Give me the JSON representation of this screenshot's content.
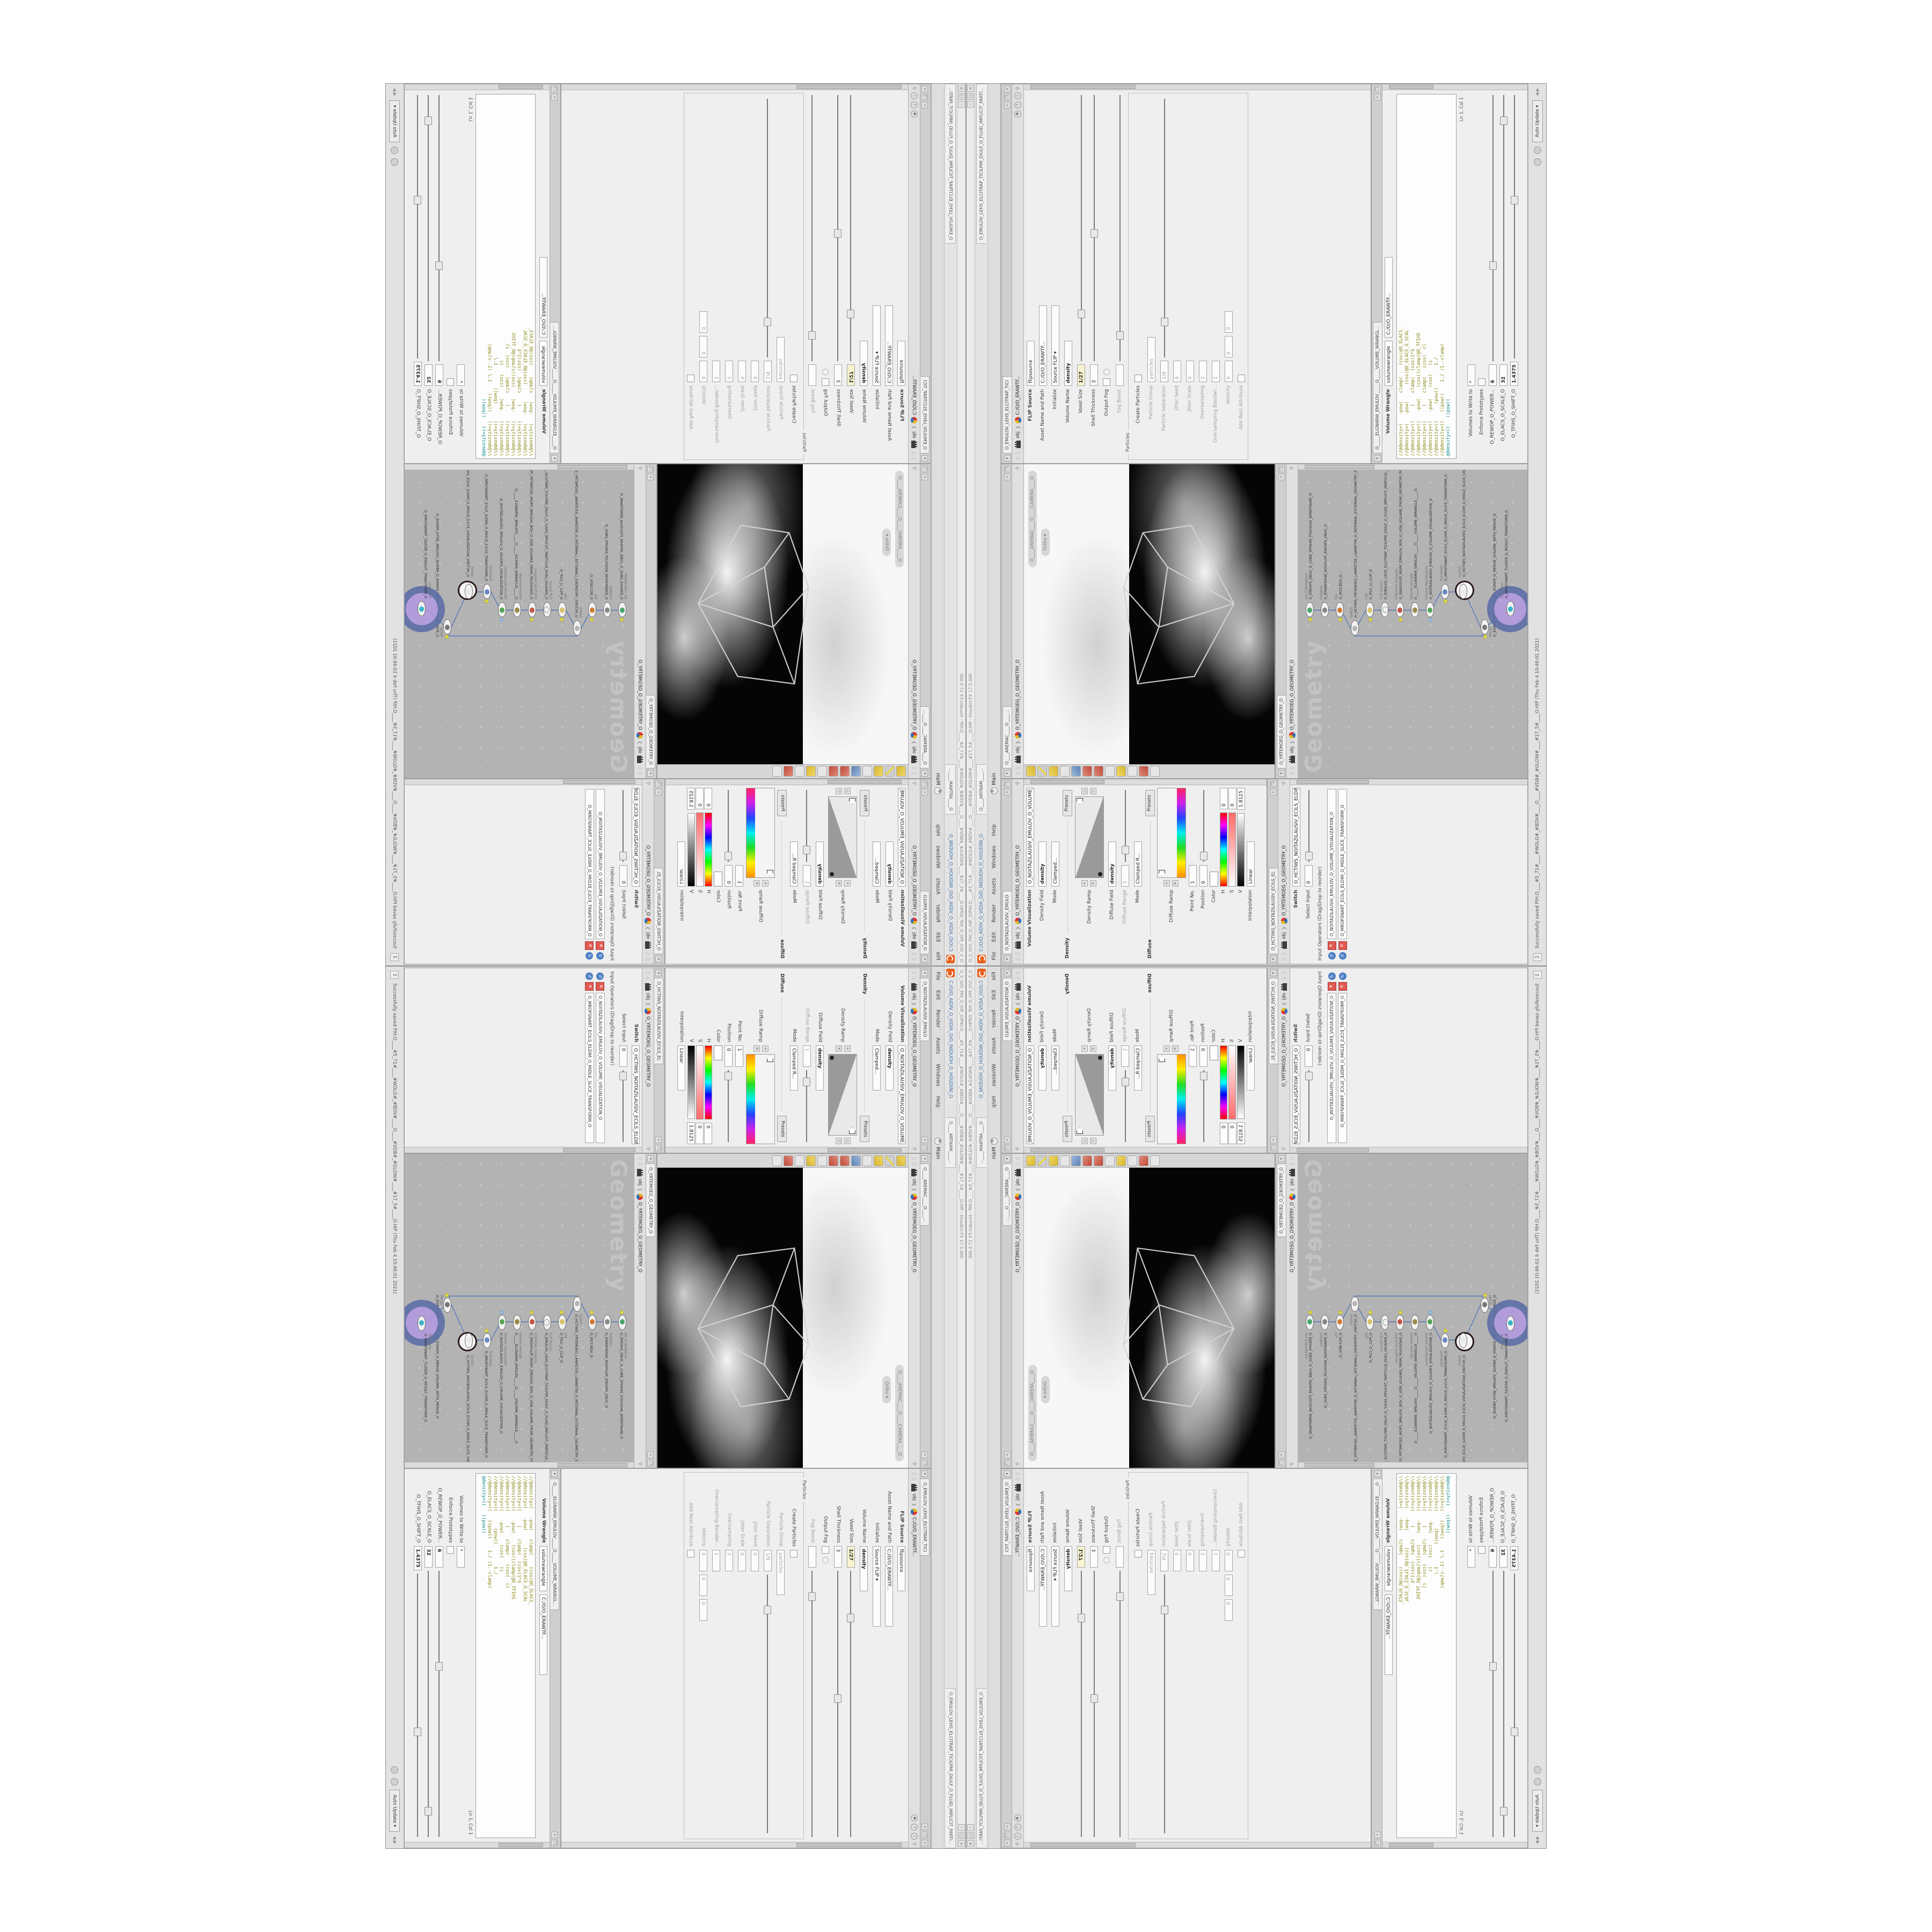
{
  "window": {
    "title": "O_5_O/O_PIH_O_HIP_O/PIH.O____#5_71#____#WOLG#_#BDV#____O____#VDB#_#GLOW#____#17_5#____O.HIP - Houdini FX 17.5.460",
    "install_path": "C:/O/O_AIDIV_O_VIDIA_O/O_INIDUOH_O_HOUDINI_O",
    "flip_window_tab": "O_EMULOV_LEHS_ELCITRAP_TICILPMI_DIULF_O_FLUID_IMPLICIT_PARTI...",
    "mantra_tab": "O____ARTNAM____...",
    "menus": [
      "File",
      "Edit",
      "Render",
      "Assets",
      "Windows",
      "Help"
    ],
    "desktop": "Main",
    "status_badge": "2",
    "status_message": "Successfully saved PIH.O____#5_71#____#WOLG#_#BDV#____O____#VDB#_#GLOW#____#17_5#____O.HIP (Thu Feb  4 10:46:01 2021)",
    "update_mode": "Auto Update",
    "accent_orange": "#e8601c",
    "selection_purple": "#b29ade"
  },
  "viewport": {
    "tab": "O____AREMAC____O____...",
    "crumb": "obj",
    "path": "O_YRTEMOEG_O_GEOMETRY_O",
    "camera_pill": "O____AREMAC____O____CAMERA____O",
    "ortho_pill": "Ortho"
  },
  "network": {
    "tab": "O_YRTEMOEG_O_GEOMETRY_O",
    "crumb": "obj",
    "path": "O_YRTEMOEG_O_GEOMETRY_O",
    "watermark": "Geometry",
    "nodes": [
      {
        "type": "am_CubeSphere",
        "name": "O_EREHPS_EBUC_O_CUBE_SPHERE_POLYGON_WIREFRAME_O"
      },
      {
        "type": "PolyWire",
        "name": "O_EMARFERIW_NOGYLOP_EREHPS_EBUC_O"
      },
      {
        "type": "File",
        "name": "O_M23.BDV_O..."
      },
      {
        "type": "Switch",
        "name": "O_HCTIWS_YRTEMOEG_LANRETXE_LANRETNI_O_INTERNAL_EXTERNAL_GEOMETRY_SWITCH_O"
      },
      {
        "type": "Clip",
        "name": "O_PILC_O_CLIP_O"
      },
      {
        "type": "FLIP Source",
        "name": "O_EMULOV_LEHS_ELCITRAP_TICILPMI_DIULF_O_FLUID_IMPLICIT_PARTICLE_SHEL_VOLUME_O"
      },
      {
        "type": "VDB from Polygons",
        "name": "O_SNOGYLOP_MORF_EMULOV_BDV_O_VDB_VOLUME_FROM_GEOMETRY_POLYGONS_O"
      },
      {
        "type": "Volume Wrangle",
        "name": "O_____ELGNARW_EMULOV_____O_____VOLUME_WRANGLE_____O"
      },
      {
        "type": "Volume Visualization",
        "name": "O_NOITAZILAUSIV_EMULOV_O_VOLUME_VISUALIZATION_O"
      },
      {
        "type": "Transform",
        "name": "O_MROFSNART_ECILS_ELDIM_O_MIDLE_SLICE_TRANSFORM_O"
      },
      {
        "type": "Switch",
        "name": "O_HCTIWS_NOITAZILAUSIV_ECILS_ELDIM_O_MIDLE_SLICE_VISUALIZATION_SWITCH_O"
      },
      {
        "type": "Merge",
        "name": "O_EGREM_HTIW_EMULOV_EGREM_O_MERGE_VOLUME_WITH_MERGE_O"
      },
      {
        "type": "Transform",
        "name": "O_MROFSNART_TLUSER_O_RESULT_TRANSFORM_O"
      }
    ]
  },
  "volume_visualization": {
    "tab": "O_NOITAZILAUSIV_EMULO",
    "crumb": "obj",
    "path": "O_YRTEMOEG_O_GEOMETRY_O",
    "title": "Volume Visualization",
    "density_field_label": "Density Field",
    "density_field": "density",
    "mode_label": "Mode",
    "density_mode": "Clamped...",
    "density_section": "Density",
    "presets": "Presets",
    "density_ramp_label": "Density Ramp",
    "diffuse_field_label": "Diffuse Field",
    "diffuse_field": "density",
    "diffuse_range_label": "Diffuse Range",
    "diffuse_range": "1",
    "diffuse_mode": "Clamped R...",
    "diffuse_section": "Diffuse",
    "diffuse_ramp_label": "Diffuse Ramp",
    "point_no_label": "Point No.",
    "point_no": "1",
    "position_label": "Position",
    "position": "0",
    "color_label": "Color",
    "h_label": "H",
    "h_value": "0",
    "s_label": "S",
    "s_value": "0",
    "v_label": "V",
    "v_value": "1.8125",
    "interpolation_label": "Interpolation",
    "interpolation": "Linear"
  },
  "switch_pane": {
    "tab": "O_HCTIWS_NOITAZILAUSIV_ECILS_EL",
    "crumb": "obj",
    "path": "O_YRTEMOEG_O_GEOMETRY_O",
    "title": "Switch",
    "select_input_label": "Select Input",
    "select_input": "0",
    "operators_label": "Input Operators (Drag/Drop to reorder)",
    "inputs": [
      "O_NOITAZILAUSIV_EMULOV_O_VOLUME_VISUALIZATION_O",
      "O_MROFSNART_ECILS_ELDIM_O_MIDLE_SLICE_TRANSFORM_O"
    ]
  },
  "flip_source": {
    "tab": "O_EMULOV_LEHS_ELCITRAP_TICI",
    "asset_path": "C:/O/O_ERAWTF...",
    "title": "FLIP Source",
    "node_name": "flipsource",
    "asset_label": "Asset Name and Path",
    "initialize_label": "Initialize",
    "initialize": "Source FLIP",
    "volume_name_label": "Volume Name",
    "volume_name": "density",
    "voxel_size_label": "Voxel Size",
    "voxel_size": "1/27",
    "shell_thickness_label": "Shell Thickness",
    "shell_thickness": "3",
    "output_fog_label": "Output Fog",
    "fog_boost_label": "Fog Boost",
    "particles_group": "Particles",
    "create_particles_label": "Create Particles",
    "particle_group_label": "Particle Group",
    "particle_group": "particles",
    "particle_separation_label": "Particle Separation",
    "particle_separation": "1/9",
    "jitter_seed_label": "Jitter Seed",
    "jitter_seed": "0",
    "jitter_scale_label": "Jitter Scale",
    "jitter_scale": "0",
    "oversampling_label": "Oversampling",
    "oversampling": "2",
    "oversampling_bw_label": "Oversampling Bandwi...",
    "oversampling_bw": "1",
    "velocity_label": "Velocity",
    "velocity": "0",
    "add_rest_label": "Add Rest Attribute"
  },
  "volume_wrangle": {
    "tab": "O_____ELGNARW_EMULOV_____O_____VOLUME_WRANGL...",
    "asset_path": "C:/O/O_ERAWTF...",
    "title": "Volume Wrangle",
    "node_name": "volumewrangle",
    "asset_label": "Asset Name and Path",
    "code": [
      "//@density=(   -pow(   clamp(    (cos(@O_ELACS_",
      "//@density=(   -pow(      (cos(@O_ELACS_O_SCAL",
      "//@density=((     (    clamp(  (cos(1*$",
      "//@density=((   -pow(    (cos((clamp(@O_TFIHS",
      "//@density=((     (    clamp(   (cos(  cl",
      "//@density=((   -pow(    (cos(   (c",
      "//@density=((      (pow((        1./",
      "//@density=((   ((pow((    1./ (1.-clamp(",
      "@density=((   ((pow(("
    ],
    "cursor_pos": "Ln 1, Col 1",
    "volumes_label": "Volumes to Write to",
    "volumes": "*",
    "enforce_label": "Enforce Prototypes",
    "power_label": "O_REWOP_O_POWER...",
    "power": "6",
    "scale_label": "O_ELACS_O_SCALE_O",
    "scale": "32",
    "shift_label": "O_TFIHS_O_SHIFT_O",
    "shift": "1.4375"
  }
}
